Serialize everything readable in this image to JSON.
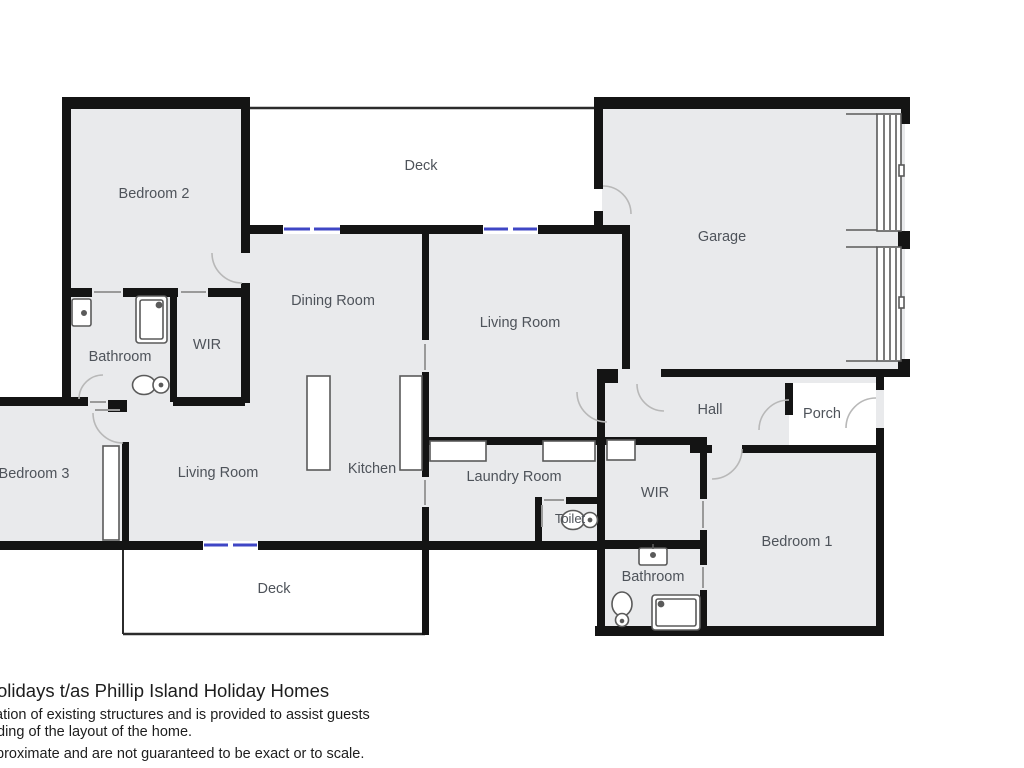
{
  "floorplan": {
    "rooms": [
      {
        "id": "bedroom-2",
        "label": "Bedroom 2"
      },
      {
        "id": "deck-top",
        "label": "Deck"
      },
      {
        "id": "garage",
        "label": "Garage"
      },
      {
        "id": "dining-room",
        "label": "Dining Room"
      },
      {
        "id": "living-room-upper",
        "label": "Living Room"
      },
      {
        "id": "hall",
        "label": "Hall"
      },
      {
        "id": "porch",
        "label": "Porch"
      },
      {
        "id": "bathroom-upper",
        "label": "Bathroom"
      },
      {
        "id": "wir-upper",
        "label": "WIR"
      },
      {
        "id": "bedroom-3",
        "label": "Bedroom 3"
      },
      {
        "id": "living-room-lower",
        "label": "Living Room"
      },
      {
        "id": "kitchen",
        "label": "Kitchen"
      },
      {
        "id": "laundry-room",
        "label": "Laundry Room"
      },
      {
        "id": "toilet",
        "label": "Toilet"
      },
      {
        "id": "wir-lower",
        "label": "WIR"
      },
      {
        "id": "bathroom-lower",
        "label": "Bathroom"
      },
      {
        "id": "bedroom-1",
        "label": "Bedroom 1"
      },
      {
        "id": "deck-bottom",
        "label": "Deck"
      }
    ],
    "fixtures": [
      "sink-icon",
      "shower-icon",
      "toilet-icon",
      "kitchen-counter",
      "laundry-bench",
      "garage-door",
      "pocket-door"
    ],
    "colors": {
      "wall": "#141414",
      "room_fill": "#e9eaec",
      "window": "#3f46c5",
      "label_text": "#4e535a",
      "door_arc": "#b8b8b8",
      "fixture_stroke": "#5a5a5a"
    }
  },
  "footer": {
    "line1": "olidays t/as Phillip Island Holiday Homes",
    "line2": "ation of existing structures and is provided to assist guests",
    "line3": "ding of the layout of the home.",
    "line4": "proximate and are not guaranteed to be exact or to scale."
  }
}
